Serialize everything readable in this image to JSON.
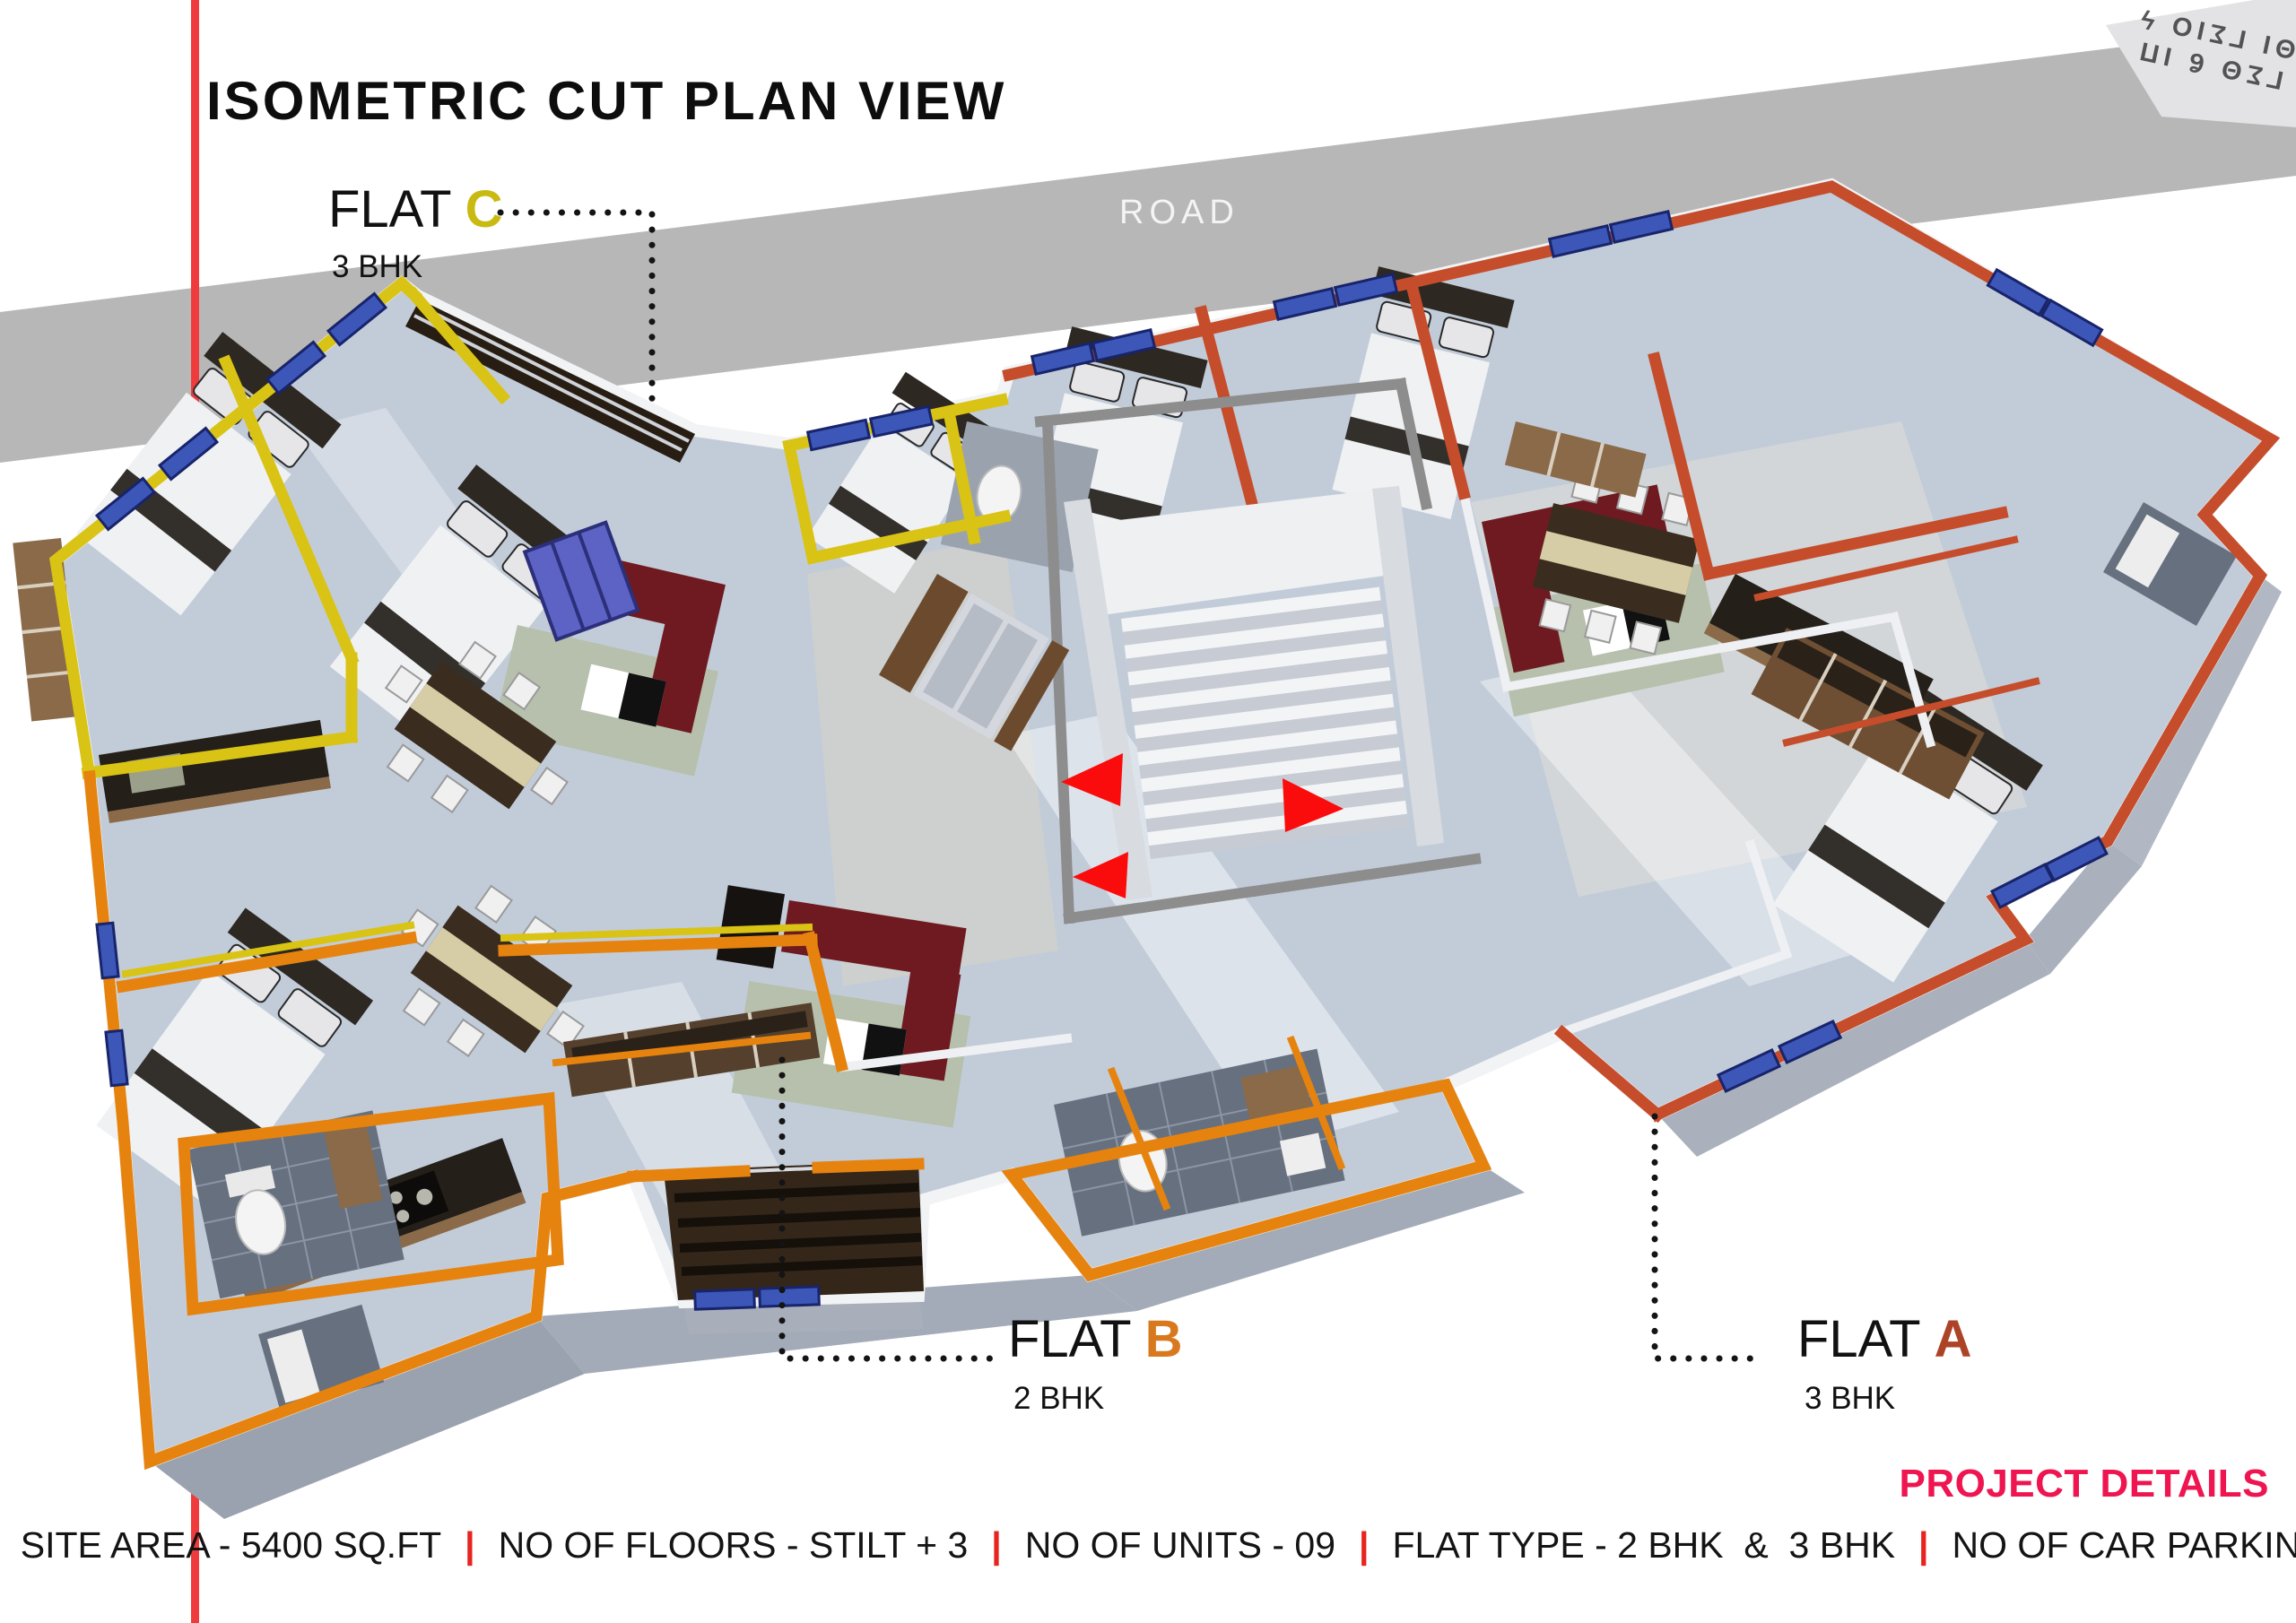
{
  "header": {
    "title": "ISOMETRIC CUT PLAN VIEW"
  },
  "road": {
    "label": "ROAD"
  },
  "corner_stamp": {
    "line1": "ΓΣΘ ϐ ΙΠ",
    "line2": "ΘΙ ΓΣΙΟ ϟ"
  },
  "flats": {
    "c": {
      "name": "FLAT ",
      "letter": "C",
      "bhk": "3 BHK",
      "letter_color": "#c9ba12",
      "wall_color": "#d9c314"
    },
    "b": {
      "name": "FLAT ",
      "letter": "B",
      "bhk": "2 BHK",
      "letter_color": "#d8791d",
      "wall_color": "#e6830f"
    },
    "a": {
      "name": "FLAT ",
      "letter": "A",
      "bhk": "3 BHK",
      "letter_color": "#ad4326",
      "wall_color": "#c54d2b"
    }
  },
  "project": {
    "heading": "PROJECT DETAILS",
    "separator": "|",
    "items": [
      "SITE AREA - 5400 SQ.FT",
      "NO OF FLOORS - STILT + 3",
      "NO OF UNITS - 09",
      "FLAT TYPE - 2 BHK  &  3 BHK",
      "NO OF CAR PARKING - 16"
    ]
  },
  "palette": {
    "road_gray": "#b7b7b7",
    "accent_red_line": "#ef3b3c",
    "details_pink": "#ee1550",
    "separator_red": "#e8241f",
    "floor_base": "#c2ccd9",
    "window_blue": "#3d57b8",
    "arrow_red": "#fb0c0c",
    "wall_c": "#d9c314",
    "wall_b": "#e6830f",
    "wall_a": "#c54d2b"
  }
}
